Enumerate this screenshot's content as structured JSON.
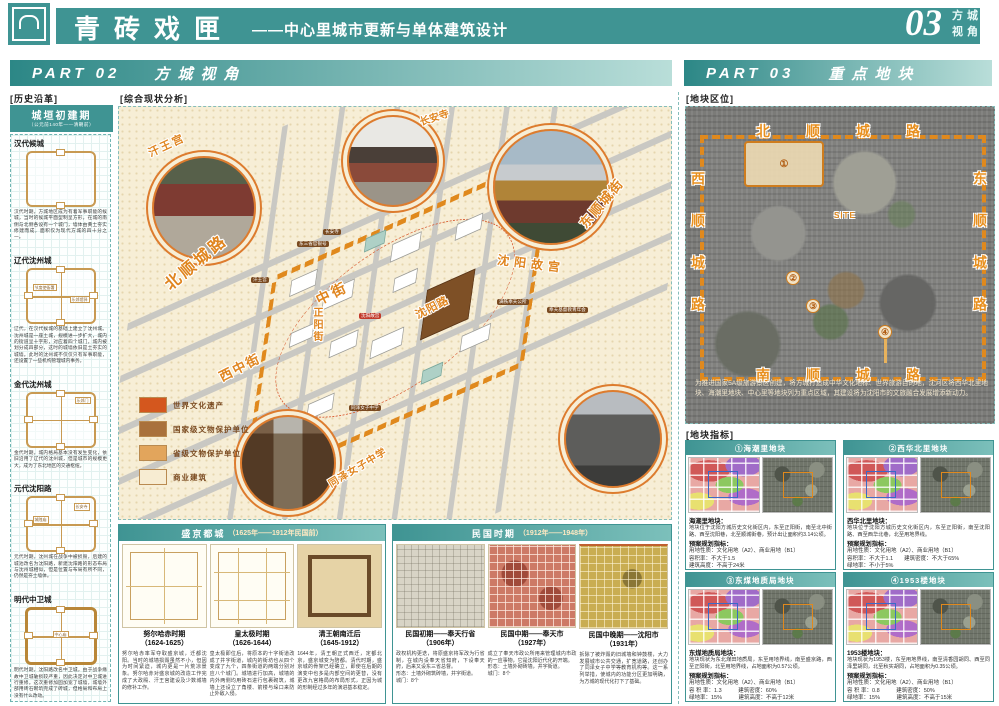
{
  "header": {
    "title": "青砖戏匣",
    "subtitle": "——中心里城市更新与单体建筑设计",
    "page_number": "03",
    "page_label_top": "方城",
    "page_label_bottom": "视角"
  },
  "part02": {
    "label": "PART 02",
    "title": "方城视角"
  },
  "part03": {
    "label": "PART 03",
    "title": "重点地块"
  },
  "history": {
    "section_label": "[历史沿革]",
    "header_title": "城垣初建期",
    "header_subtitle": "（公元前140年——清朝前）",
    "eras": [
      {
        "name": "汉代候城",
        "text": "汉代时期，方城地区成为有着军事职能的候城，当时的候城平面型制呈方形，在城的南侧与北侧各设有一个城门，墙体由黄土夯实修建而成，面积仅为现代方城的四十分之一。"
      },
      {
        "name": "辽代沈州城",
        "label_left": "节度使衙署",
        "label_right": "乐郊馆驿",
        "text": "辽代，在汉代候城的基础上建立了沈州城。沈州城是一座土城，规模进一步扩大，城内的街道呈十字形，对应着四个城门，城内被划分成四部分，这时的城墙依旧是土夯实的城墙。此时的沈州城不仅仅只有军事职能，还设置了一些机构管理城内事务。"
      },
      {
        "name": "金代沈州城",
        "label_top": "乐郊门",
        "text": "金代时期，城内格局基本没有发生变化，依旧沿用了辽代的沈州城，但是城市的规模更大，成为了东北地区的交通枢纽。"
      },
      {
        "name": "元代沈阳路",
        "label_left": "城隍庙",
        "label_top": "长安寺",
        "text": "元代时期，沈州城在战争中被损毁，后建的城池改名为沈阳路，新建沈阳路的形态布局与沈州城相似，但是位置与布局有所不同，仍然是夯土墙体。"
      },
      {
        "name": "明代中卫城",
        "label_center": "中心庙",
        "text": "明代时期，沈阳路改名中卫城，由于战争缘故中卫城破损较严重，因此决定对中卫城进行重修。这次重修加固加宽了城墙，城墙外部用砖石砌筑完成了砖城，但格局和布局上没有什么改动。"
      }
    ]
  },
  "analysis": {
    "section_label": "[综合现状分析]",
    "roads": {
      "bei": "北顺城路",
      "dong": "东顺城街",
      "zhong": "中街",
      "xizhong": "西中街",
      "zhengyang": "正阳街",
      "shenyanglu": "沈阳路"
    },
    "photos": {
      "hanwanggong": "汗王宫",
      "changansi": "长安寺",
      "gugong": "沈阳故宫",
      "tongze": "同泽女子中学"
    },
    "tags": [
      "长安寺",
      "东三省官银号",
      "汗王宫",
      "满铁奉天公所",
      "奉天基督教青年会",
      "同泽女子中学"
    ],
    "red_tag": "沈阳故宫",
    "legend": [
      {
        "label": "世界文化遗产",
        "color": "#d4571e"
      },
      {
        "label": "国家级文物保护单位",
        "color": "#a9713c"
      },
      {
        "label": "省级文物保护单位",
        "color": "#e2a55c"
      },
      {
        "label": "商业建筑",
        "color": "#f7ecd2"
      }
    ]
  },
  "shengjing": {
    "title": "盛京都城",
    "subtitle": "（1625年——1912年民国前）",
    "periods": [
      {
        "name": "努尔哈赤时期",
        "years": "（1624-1625）",
        "text": "努尔哈赤率军夺取盛京城，迁都沈阳。当时的城墙损毁虽然不小，但因为时间紧迫，城内更是一片荒凉景象。努尔哈赤对盛京城的改造工作完成了大政殿、汗王宫建设及少数城墙的修补工作。"
      },
      {
        "name": "皇太极时期",
        "years": "（1626-1644）",
        "text": "皇太极即位后，将原本的十字街道改成了井字街道，城内的街坊也从四个变成了九个，四条街道的两端分别对应八个城门。城墙进行加高，城墙的内外两侧均用砖石进行包裹砌筑，城墙上还设立了角楼、箭楼与垛口来防止外敌入侵。"
      },
      {
        "name": "清王朝南迁后",
        "years": "（1645-1912）",
        "text": "1644年，清王朝正式西迁，定都北京，盛京城变为陪都。清代时期，盛京城的骨架已经确立，即使在后期的演变中也多是内部空间的更替，没有更改九宫格局的布局形式，正因为城的形制经过多年的演进基本稳定。"
      }
    ]
  },
  "minguo": {
    "title": "民国时期",
    "subtitle": "（1912年——1948年）",
    "periods": [
      {
        "name": "民国初期——奉天行省",
        "years": "（1906年）",
        "text": "政权机构更迭，将原盛京将军改为行省制，在城内设奉天省知府，下设奉天府，后来又设东三省总督。\n形态：土墙外砌筑砖墙，井字街道。\n城门：8个"
      },
      {
        "name": "民国中期——奉天市",
        "years": "（1927年）",
        "text": "成立了奉天市政公所用来管理城内市政的一应事物，它是沈阳近代化的开端。\n形态：土墙外砌砖墙，井字街道。\n城门：8个"
      },
      {
        "name": "民国中晚期——沈阳市",
        "years": "（1931年）",
        "text": "拆除了被炸毁的旧城墙和钟鼓楼，大力发展城市公共交通，扩宽道路，还创办了同泽女子中学等教育机构等。这一系列举措，使城内的功能分区更加明确，为方城的现代化打下了基础。"
      }
    ]
  },
  "location": {
    "section_label": "[地块区位]",
    "roads": {
      "north": "北顺城路",
      "south": "南顺城路",
      "west": "西顺城路",
      "east": "东顺城路"
    },
    "site": "SITE",
    "markers": [
      "①",
      "②",
      "③",
      "④"
    ],
    "caption": "为推进国家5A级旅游景区创建，将方城打造成中华文化地标、世界旅游目的地，沈河区将西华北里地块、海潮里地块、中心里等地块列为重点区域，其建设将为沈阳市的文旅融合发展增添新动力。"
  },
  "indicators": {
    "section_label": "[地块指标]",
    "plots": [
      {
        "title": "①海潮里地块",
        "name": "海潮里地块：",
        "desc": "地块位于沈阳方城历史文化街区内，东至正阳街，南至北中街路、西至沈阳巷，北至顺城街巷，预计出让面积约3.14公顷。",
        "metrics_label": "预案规划指标：",
        "line1": "用地性质：文化用地（A2）、商业用地（B1）",
        "line2": "容积率：不大于1.5",
        "line3": "建筑高度：不高于24米"
      },
      {
        "title": "②西华北里地块",
        "name": "西华北里地块：",
        "desc": "地块位于沈阳方城历史文化街区内，东至正阳街，南至沈阳路、西至西华北巷，北至用地界线。",
        "metrics_label": "预案规划指标：",
        "line1": "用地性质：文化用地（A2）、商业用地（B1）",
        "line2": "容积率：不大于1.1　　建筑密度：不大于65%",
        "line3": "绿地率：不小于5%"
      },
      {
        "title": "③东煤地质局地块",
        "name": "东煤地质局地块：",
        "desc": "地块现状为东北煤田地质局，东至用地界线，南至盛京路，西至正阳街，北至用地界线，占地面积为0.57公顷。",
        "metrics_label": "预案规划指标：",
        "line1": "用地性质：文化用地（A2）、商业用地（B1）",
        "line2": "容 积 率：1.3　　　建筑密度：60%",
        "line3": "绿地率：15%　　　建筑高度：不高于12米"
      },
      {
        "title": "④1953楼地块",
        "name": "1953楼地块：",
        "desc": "地块现状为1953楼，东至用地界线，南至清香园胡同、西至同泽里胡同，北至秋实胡同，占地面积为0.35公顷。",
        "metrics_label": "预案规划指标：",
        "line1": "用地性质：文化用地（A2）、商业用地（B1）",
        "line2": "容 积 率：0.8　　　建筑密度：50%",
        "line3": "绿地率：15%　　　建筑高度：不高于15米"
      }
    ]
  }
}
